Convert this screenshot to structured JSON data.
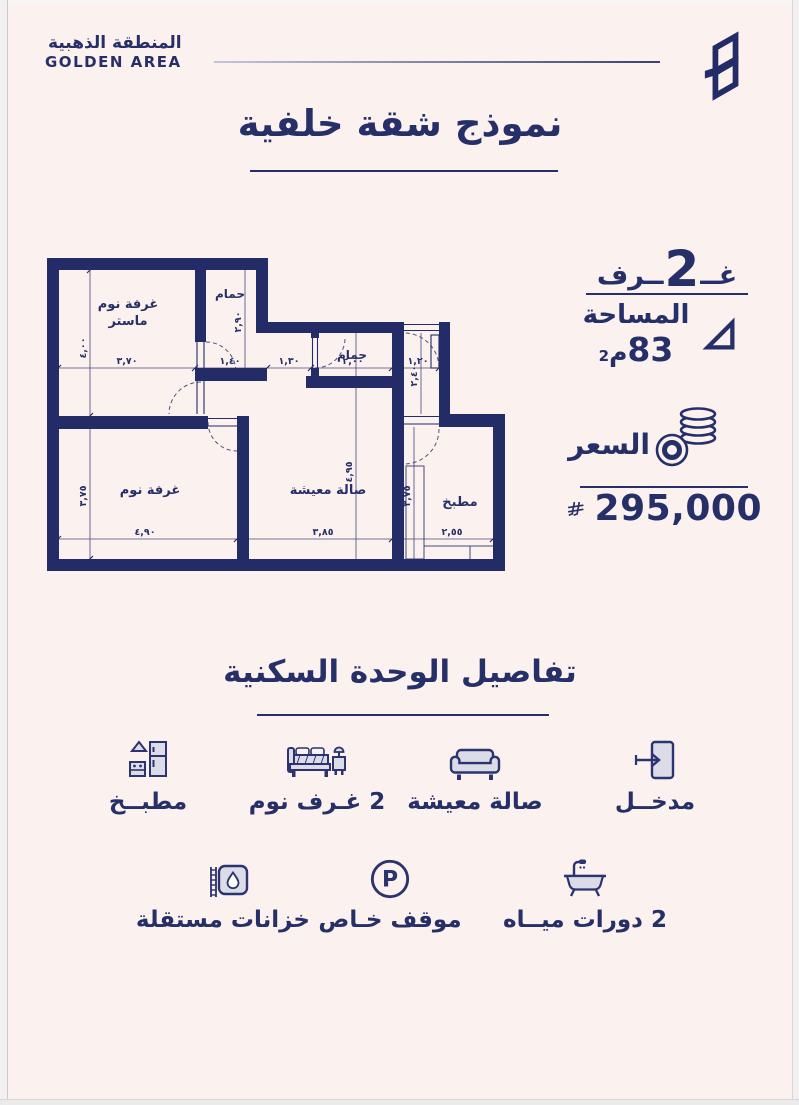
{
  "header": {
    "brand_ar": "المنطقة الذهبية",
    "brand_en": "GOLDEN AREA"
  },
  "title": {
    "text": "نموذج شقة خلفية"
  },
  "summary": {
    "rooms_pre": "غــ",
    "rooms_num": "2",
    "rooms_post": "ــرف",
    "area_label": "المساحة",
    "area_value": "83",
    "area_unit_letter": "م",
    "area_unit_exp": "2",
    "price_label": "السعر",
    "price_value": "295,000"
  },
  "floorplan": {
    "rooms": {
      "master_l1": "غرفة نوم",
      "master_l2": "ماستر",
      "bath1": "حمام",
      "bath2": "حمام",
      "bedroom": "غرفة نوم",
      "living": "صالة معيشة",
      "kitchen": "مطبخ"
    },
    "dims": {
      "master_w": "٣,٧٠",
      "bath1_w": "١,٤٠",
      "hall_w": "١,٣٠",
      "bath2_w": "٢,٠٠",
      "entry_w": "١,٢٠",
      "master_h": "٤,٠٠",
      "bath1_h": "٢,٩٠",
      "entry_h": "٢,٤٠",
      "bedroom_w": "٤,٩٠",
      "living_w": "٣,٨٥",
      "kitchen_w": "٢,٥٥",
      "bedroom_h": "٣,٧٥",
      "living_h": "٤,٩٥",
      "kitchen_h": "٣,٧٥"
    }
  },
  "details": {
    "title": "تفاصيل الوحدة السكنية",
    "row1": [
      {
        "name": "kitchen",
        "label": "مطبــخ"
      },
      {
        "name": "bedrooms",
        "label": "2 غـرف نوم"
      },
      {
        "name": "living",
        "label": "صالة معيشة"
      },
      {
        "name": "entrance",
        "label": "مدخــل"
      }
    ],
    "row2": [
      {
        "name": "tanks",
        "label": "خزانات مستقلة"
      },
      {
        "name": "parking",
        "label": "موقف خـاص"
      },
      {
        "name": "bathrooms",
        "label": "2 دورات ميــاه"
      }
    ]
  },
  "colors": {
    "navy": "#262f68",
    "background": "#fbf1ee"
  }
}
